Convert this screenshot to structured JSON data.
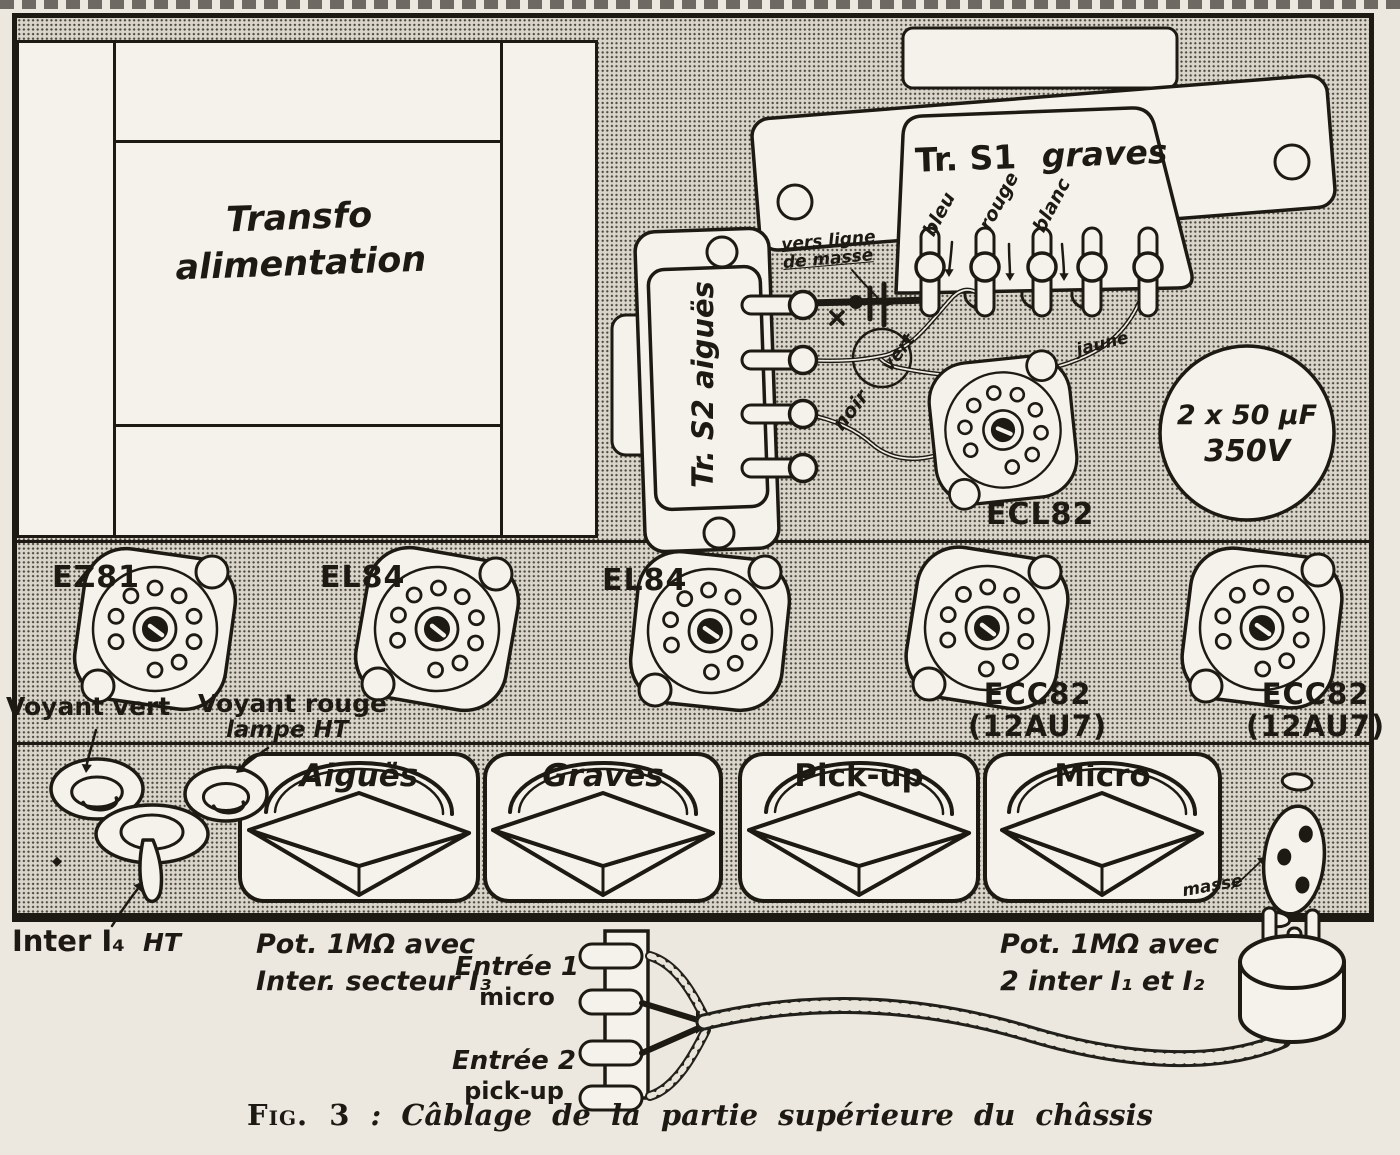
{
  "figure": {
    "fig_label": "Fig. 3",
    "separator": " : ",
    "caption": "Câblage de la partie supérieure du châssis"
  },
  "power_transformer": {
    "line1": "Transfo",
    "line2": "alimentation"
  },
  "output_transformer_bass": {
    "name": "Tr. S1",
    "channel": "graves",
    "wire_blue": "bleu",
    "wire_red": "rouge",
    "wire_white": "blanc",
    "ground_note_line1": "vers ligne",
    "ground_note_line2": "de masse",
    "wire_yellow": "jaune"
  },
  "output_transformer_treble": {
    "name": "Tr. S2 aiguës",
    "wire_black": "noir",
    "wire_green": "vert"
  },
  "filter_capacitor": {
    "value": "2 x 50 µF",
    "voltage": "350V"
  },
  "tube_sockets": [
    {
      "label": "EZ81"
    },
    {
      "label": "EL84"
    },
    {
      "label": "EL84"
    },
    {
      "label": "ECL82"
    },
    {
      "label": "ECC82",
      "equivalent": "(12AU7)"
    },
    {
      "label": "ECC82",
      "equivalent": "(12AU7)"
    }
  ],
  "indicators": {
    "green_lamp": "Voyant vert",
    "red_lamp_line1": "Voyant rouge",
    "red_lamp_line2": "lampe HT",
    "ht_switch": "Inter I₄",
    "ht_switch_suffix": "HT"
  },
  "controls": {
    "knobs": [
      {
        "label": "Aiguës"
      },
      {
        "label": "Graves"
      },
      {
        "label": "Pick-up"
      },
      {
        "label": "Micro"
      }
    ]
  },
  "potentiometers": {
    "left_line1": "Pot. 1MΩ avec",
    "left_line2": "Inter. secteur I₃",
    "right_line1": "Pot. 1MΩ avec",
    "right_line2": "2 inter I₁ et I₂"
  },
  "inputs": {
    "input1_line1": "Entrée 1",
    "input1_line2": "micro",
    "input2_line1": "Entrée 2",
    "input2_line2": "pick-up"
  },
  "ground_label": "masse",
  "colors": {
    "ink": "#1d1a14",
    "paper": "#ece8df",
    "halftone_base": "#d9d5ca",
    "white_fill": "#f4f2ea"
  }
}
